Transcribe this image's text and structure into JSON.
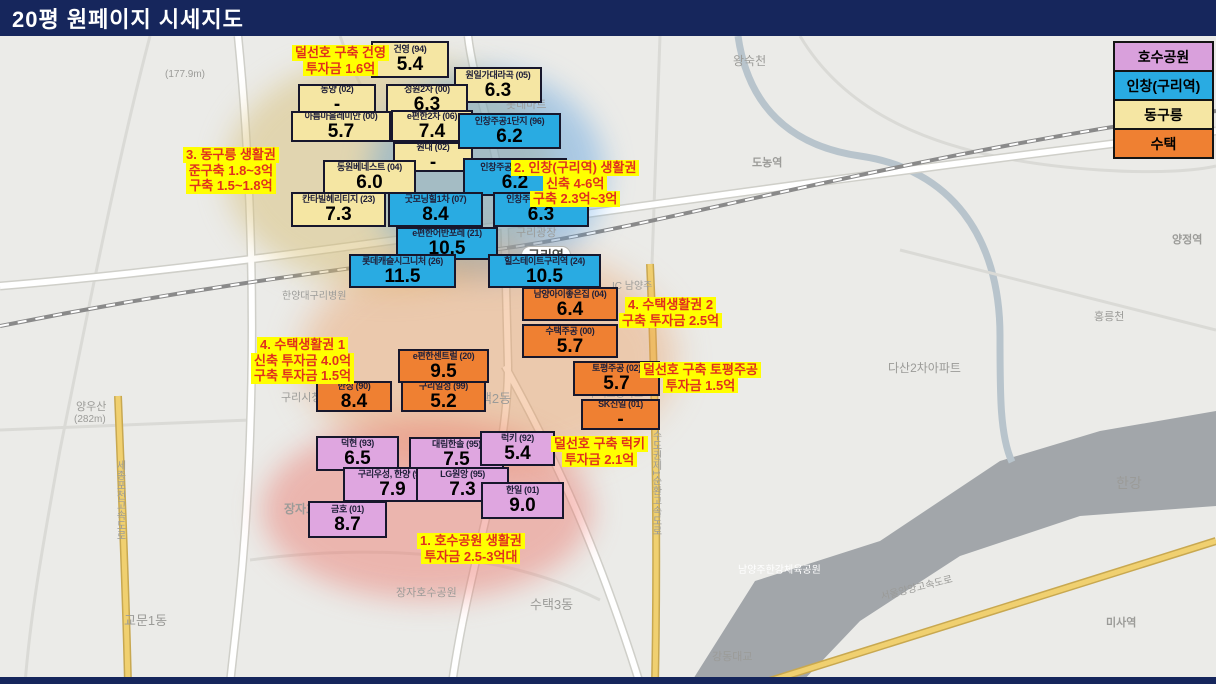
{
  "title": "20평 원페이지 시세지도",
  "legend": {
    "items": [
      {
        "label": "호수공원",
        "color": "#d9a0dc"
      },
      {
        "label": "인창(구리역)",
        "color": "#29abe2"
      },
      {
        "label": "동구릉",
        "color": "#f5e6a3"
      },
      {
        "label": "수택",
        "color": "#ef8032"
      }
    ]
  },
  "categories": {
    "hosu": "#dfa6e0",
    "inchang": "#29abe2",
    "donggureung": "#f5e6a3",
    "sutaek": "#ef8032"
  },
  "boxes": [
    {
      "name": "건영 (94)",
      "value": "5.4",
      "category": "donggureung",
      "x": 371,
      "y": 41,
      "w": 78,
      "h": 37
    },
    {
      "name": "원일가대라곡 (05)",
      "value": "6.3",
      "category": "donggureung",
      "x": 454,
      "y": 67,
      "w": 88,
      "h": 36
    },
    {
      "name": "동양 (02)",
      "value": "-",
      "category": "donggureung",
      "x": 298,
      "y": 84,
      "w": 78,
      "h": 30
    },
    {
      "name": "성원2차 (00)",
      "value": "6.3",
      "category": "donggureung",
      "x": 386,
      "y": 84,
      "w": 82,
      "h": 31
    },
    {
      "name": "아름마을레미안 (00)",
      "value": "5.7",
      "category": "donggureung",
      "x": 291,
      "y": 111,
      "w": 100,
      "h": 31
    },
    {
      "name": "e편한2차 (06)",
      "value": "7.4",
      "category": "donggureung",
      "x": 391,
      "y": 110,
      "w": 82,
      "h": 32
    },
    {
      "name": "원대 (02)",
      "value": "-",
      "category": "donggureung",
      "x": 393,
      "y": 142,
      "w": 80,
      "h": 30
    },
    {
      "name": "동원베네스트 (04)",
      "value": "6.0",
      "category": "donggureung",
      "x": 323,
      "y": 160,
      "w": 93,
      "h": 34
    },
    {
      "name": "칸타빌헤리티지 (23)",
      "value": "7.3",
      "category": "donggureung",
      "x": 291,
      "y": 192,
      "w": 95,
      "h": 35
    },
    {
      "name": "인창주공1단지 (96)",
      "value": "6.2",
      "category": "inchang",
      "x": 458,
      "y": 113,
      "w": 103,
      "h": 36
    },
    {
      "name": "인창주공4단지 (96)",
      "value": "6.2",
      "category": "inchang",
      "x": 463,
      "y": 158,
      "w": 104,
      "h": 38
    },
    {
      "name": "굿모닝힐1차 (07)",
      "value": "8.4",
      "category": "inchang",
      "x": 388,
      "y": 192,
      "w": 95,
      "h": 35
    },
    {
      "name": "인창주공6단지 (96)",
      "value": "6.3",
      "category": "inchang",
      "x": 493,
      "y": 192,
      "w": 96,
      "h": 35
    },
    {
      "name": "e편한어반포레 (21)",
      "value": "10.5",
      "category": "inchang",
      "x": 396,
      "y": 227,
      "w": 102,
      "h": 33
    },
    {
      "name": "롯데캐슬시그니처 (26)",
      "value": "11.5",
      "category": "inchang",
      "x": 349,
      "y": 254,
      "w": 107,
      "h": 34
    },
    {
      "name": "힐스테이트구리역 (24)",
      "value": "10.5",
      "category": "inchang",
      "x": 488,
      "y": 254,
      "w": 113,
      "h": 34
    },
    {
      "name": "남양아이좋은집 (04)",
      "value": "6.4",
      "category": "sutaek",
      "x": 522,
      "y": 287,
      "w": 96,
      "h": 34
    },
    {
      "name": "수택주공 (00)",
      "value": "5.7",
      "category": "sutaek",
      "x": 522,
      "y": 324,
      "w": 96,
      "h": 34
    },
    {
      "name": "e편한센트럴 (20)",
      "value": "9.5",
      "category": "sutaek",
      "x": 398,
      "y": 349,
      "w": 91,
      "h": 34
    },
    {
      "name": "구리일성 (99)",
      "value": "5.2",
      "category": "sutaek",
      "x": 401,
      "y": 381,
      "w": 85,
      "h": 31
    },
    {
      "name": "한성 (90)",
      "value": "8.4",
      "category": "sutaek",
      "x": 316,
      "y": 381,
      "w": 76,
      "h": 31
    },
    {
      "name": "토평주공 (02)",
      "value": "5.7",
      "category": "sutaek",
      "x": 573,
      "y": 361,
      "w": 87,
      "h": 35
    },
    {
      "name": "SK신일 (01)",
      "value": "-",
      "category": "sutaek",
      "x": 581,
      "y": 399,
      "w": 79,
      "h": 31
    },
    {
      "name": "덕현 (93)",
      "value": "6.5",
      "category": "hosu",
      "x": 316,
      "y": 436,
      "w": 83,
      "h": 35
    },
    {
      "name": "대림한솔 (95)",
      "value": "7.5",
      "category": "hosu",
      "x": 409,
      "y": 437,
      "w": 95,
      "h": 35
    },
    {
      "name": "럭키 (92)",
      "value": "5.4",
      "category": "hosu",
      "x": 480,
      "y": 431,
      "w": 75,
      "h": 35
    },
    {
      "name": "구리우성, 한양 (94)",
      "value": "7.9",
      "category": "hosu",
      "x": 343,
      "y": 467,
      "w": 99,
      "h": 35
    },
    {
      "name": "LG원앙 (95)",
      "value": "7.3",
      "category": "hosu",
      "x": 416,
      "y": 467,
      "w": 93,
      "h": 35
    },
    {
      "name": "한일 (01)",
      "value": "9.0",
      "category": "hosu",
      "x": 481,
      "y": 482,
      "w": 83,
      "h": 37
    },
    {
      "name": "금호 (01)",
      "value": "8.7",
      "category": "hosu",
      "x": 308,
      "y": 501,
      "w": 79,
      "h": 37
    }
  ],
  "annotations": [
    {
      "lines": [
        "덜선호 구축 건영",
        "투자금 1.6억"
      ],
      "x": 292,
      "y": 45
    },
    {
      "lines": [
        "3. 동구릉 생활권",
        "준구축 1.8~3억",
        "구축 1.5~1.8억"
      ],
      "x": 183,
      "y": 147
    },
    {
      "lines": [
        "2. 인창(구리역) 생활권",
        "신축 4-6억",
        "구축 2.3억~3억"
      ],
      "x": 511,
      "y": 160
    },
    {
      "lines": [
        "4. 수택생활권 2",
        "구축 투자금 2.5억"
      ],
      "x": 619,
      "y": 297
    },
    {
      "lines": [
        "4. 수택생활권 1",
        "신축 투자금 4.0억",
        "구축 투자금 1.5억"
      ],
      "x": 251,
      "y": 337
    },
    {
      "lines": [
        "덜선호 구축 토평주공",
        "투자금 1.5억"
      ],
      "x": 640,
      "y": 362
    },
    {
      "lines": [
        "덜선호 구축 럭키",
        "투자금 2.1억"
      ],
      "x": 551,
      "y": 436
    },
    {
      "lines": [
        "1. 호수공원 생활권",
        "투자금 2.5-3억대"
      ],
      "x": 417,
      "y": 533
    }
  ],
  "map_labels": [
    {
      "text": "(177.9m)",
      "x": 165,
      "y": 70,
      "size": 10
    },
    {
      "text": "왕숙천",
      "x": 733,
      "y": 55,
      "size": 12
    },
    {
      "text": "도농역",
      "x": 752,
      "y": 158,
      "size": 11,
      "bold": true
    },
    {
      "text": "양정역",
      "x": 1172,
      "y": 235,
      "size": 11,
      "bold": true
    },
    {
      "text": "롯데마트",
      "x": 506,
      "y": 100,
      "size": 11
    },
    {
      "text": "구리광장",
      "x": 516,
      "y": 228,
      "size": 11
    },
    {
      "text": "구리역",
      "x": 521,
      "y": 246,
      "size": 13,
      "bold": true,
      "pill": true
    },
    {
      "text": "한양대구리병원",
      "x": 282,
      "y": 292,
      "size": 10
    },
    {
      "text": "IC 남양주",
      "x": 612,
      "y": 282,
      "size": 10
    },
    {
      "text": "구리시청",
      "x": 281,
      "y": 393,
      "size": 11
    },
    {
      "text": "수택2동",
      "x": 468,
      "y": 392,
      "size": 13
    },
    {
      "text": "수택고등학교",
      "x": 588,
      "y": 390,
      "size": 10
    },
    {
      "text": "양우산",
      "x": 76,
      "y": 402,
      "size": 11
    },
    {
      "text": "(282m)",
      "x": 74,
      "y": 415,
      "size": 10
    },
    {
      "text": "장자호수공원역",
      "x": 284,
      "y": 503,
      "size": 12,
      "bold": true
    },
    {
      "text": "장자호수공원",
      "x": 396,
      "y": 588,
      "size": 11
    },
    {
      "text": "한강",
      "x": 1116,
      "y": 476,
      "size": 14
    },
    {
      "text": "수택3동",
      "x": 530,
      "y": 598,
      "size": 13
    },
    {
      "text": "교문1동",
      "x": 124,
      "y": 614,
      "size": 13
    },
    {
      "text": "미사역",
      "x": 1106,
      "y": 618,
      "size": 11,
      "bold": true
    },
    {
      "text": "강동대교",
      "x": 712,
      "y": 652,
      "size": 11
    },
    {
      "text": "홍릉천",
      "x": 1094,
      "y": 312,
      "size": 11
    },
    {
      "text": "다산2차아파트",
      "x": 888,
      "y": 362,
      "size": 12
    },
    {
      "text": "남양주한강체육공원",
      "x": 738,
      "y": 566,
      "size": 10,
      "color": "#ffffff"
    },
    {
      "text": "수도권제1순환고속도로",
      "x": 650,
      "y": 430,
      "size": 10,
      "vertical": true
    },
    {
      "text": "세종포천고속도로",
      "x": 114,
      "y": 460,
      "size": 10,
      "vertical": true
    },
    {
      "text": "서울양양고속도로",
      "x": 880,
      "y": 584,
      "size": 10,
      "rotate": -14
    }
  ]
}
